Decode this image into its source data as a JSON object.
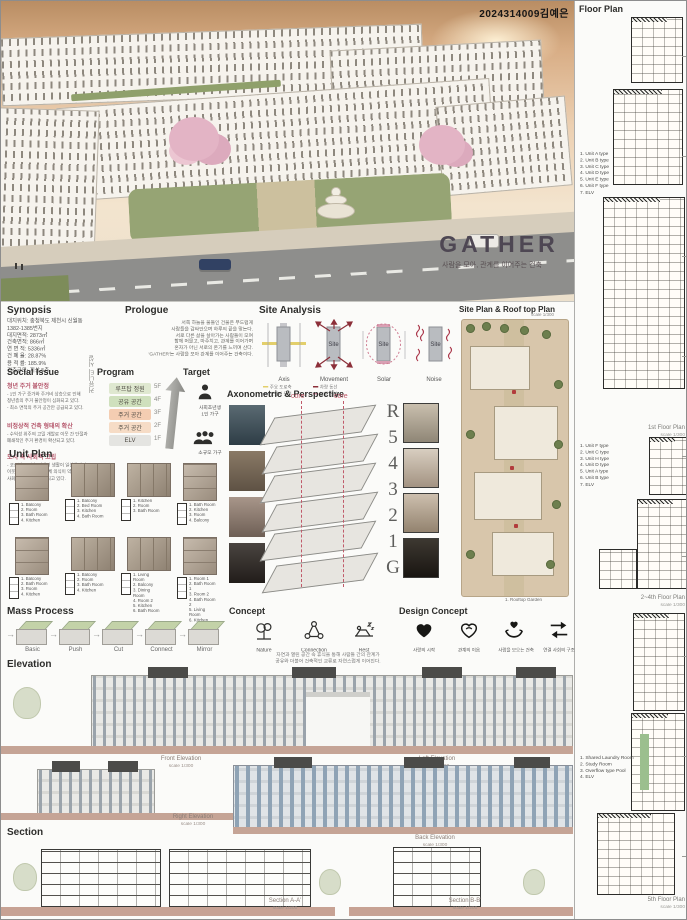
{
  "header": {
    "student_id": "2024314009김예은"
  },
  "hero": {
    "title": "GATHER",
    "subtitle": "사람을 모아, 관계를 이어주는 건축"
  },
  "synopsis": {
    "heading": "Synopsis",
    "lines": [
      "대지위치: 충청북도 제천시 신월동",
      "1382-1385번지",
      "대지면적: 2873㎡",
      "건축면적: 866㎡",
      "연 면 적: 5336㎡",
      "건 폐 율: 28.87%",
      "용 적 률: 185.9%",
      "건축규모: 지상 5층"
    ]
  },
  "prologue": {
    "heading": "Prologue",
    "text": "서쪽 하늘을 물들인 건물은 부드럽게\n사람들을 감싸안으며 하루의 끝을 맞는다.\n서로 다른 삶을 살아가는 사람들이 모여\n함께 머물고, 마주치고, 관계를 이어가며\n혼자가 아닌 서로의 온기를 느끼며 산다.\n'GATHER'는 사람을 모아 관계를 이어주는 건축이다."
  },
  "site_analysis": {
    "heading": "Site Analysis",
    "site_label": "Site",
    "diagrams": [
      {
        "label": "Axis"
      },
      {
        "label": "Movement"
      },
      {
        "label": "Solar"
      },
      {
        "label": "Noise"
      }
    ],
    "legends": [
      "주요 도로축",
      "보행자 동선",
      "차량 동선",
      "보행 동선"
    ]
  },
  "site_plan": {
    "heading": "Site Plan & Roof top Plan",
    "scale": "scale 1/300",
    "caption": "1. Rooftop Garden"
  },
  "social_issue": {
    "heading": "Social Issue",
    "items": [
      {
        "title": "청년 주거 불안정",
        "body": "- 1인 가구 증가와 주거비 상승으로 인해\n  청년층의 주거 불안정이 심화되고 있다.\n- 최소 면적의 주거 공간만 공급되고 있다."
      },
      {
        "title": "비정상적 건축 형태의 확산",
        "body": "- 수익성 위주의 고밀 개발로 이웃 간 단절과\n  폐쇄적인 주거 환경이 확산되고 있다."
      },
      {
        "title": "도시 속 사회적 고립",
        "body": "- 코로나19 이후 비대면 생활이 일상화되며\n  이웃 간의 교류와 공동체 의식이 약화되고\n  사회적 고립감이 심화되고 있다."
      }
    ]
  },
  "program": {
    "heading": "Program",
    "side_label": "커뮤니티 시설",
    "rows": [
      {
        "label": "루프탑 정원"
      },
      {
        "label": "공유 공간"
      },
      {
        "label": "주거 공간"
      },
      {
        "label": "주거 공간"
      },
      {
        "label": "ELV"
      }
    ],
    "floors": [
      "5F",
      "4F",
      "3F",
      "2F",
      "1F"
    ],
    "colors": {
      "row1": "#dfe8d0",
      "row2": "#cfe0bd",
      "row3": "#f4cdb2",
      "row4": "#f6dcc6",
      "row5": "#e4e4e1",
      "accent": "#8c2f39"
    }
  },
  "target": {
    "heading": "Target",
    "items": [
      {
        "label": "사회초년생\n1인 가구"
      },
      {
        "label": "소규모 가구"
      }
    ]
  },
  "unit_plan": {
    "heading": "Unit Plan",
    "units": [
      {
        "legend": "1. Balcony\n2. Room\n3. Bath Room\n4. Kitchen"
      },
      {
        "legend": "1. Balcony\n2. Bed Room\n3. Kitchen\n4. Bath Room"
      },
      {
        "legend": "1. Kitchen\n2. Room\n3. Bath Room"
      },
      {
        "legend": "1. Bath Room\n2. Kitchen\n3. Room\n4. Balcony"
      },
      {
        "legend": "1. Balcony\n2. Bath Room\n3. Room\n4. Kitchen"
      },
      {
        "legend": "1. Balcony\n2. Room\n3. Bath Room\n4. Kitchen"
      },
      {
        "legend": "1. Living Room\n2. Balcony\n3. Dining Room\n4. Room 2\n5. Kitchen\n6. Bath Room"
      },
      {
        "legend": "1. Room 1\n2. Bath Room 1\n3. Room 2\n4. Bath Room 2\n5. Living Room\n6. Kitchen"
      }
    ]
  },
  "axono": {
    "heading": "Axonometric & Perspective",
    "core_label": "core",
    "levels": [
      "R",
      "5",
      "4",
      "3",
      "2",
      "1",
      "G"
    ]
  },
  "mass_process": {
    "heading": "Mass Process",
    "steps": [
      {
        "label": "Basic"
      },
      {
        "label": "Push"
      },
      {
        "label": "Cut"
      },
      {
        "label": "Connect"
      },
      {
        "label": "Mirror"
      }
    ]
  },
  "concept": {
    "heading": "Concept",
    "items": [
      {
        "label": "Nature"
      },
      {
        "label": "Connection"
      },
      {
        "label": "Rest"
      }
    ],
    "caption": "자연과 열린 공간 속 휴식을 통해 사람들 간의 관계가\n공유와 더불어 건축적인 교류로 자연스럽게 이어진다."
  },
  "design_concept": {
    "heading": "Design Concept",
    "items": [
      {
        "label": "사랑의 시작"
      },
      {
        "label": "관계의 이음"
      },
      {
        "label": "사람을 모으는 건축"
      },
      {
        "label": "연결 사회의 구조"
      }
    ]
  },
  "elevation": {
    "heading": "Elevation",
    "captions": [
      {
        "title": "Front Elevation",
        "scale": "scale 1/300"
      },
      {
        "title": "Left Elevation",
        "scale": "scale 1/300"
      },
      {
        "title": "Right Elevation",
        "scale": "scale 1/300"
      },
      {
        "title": "Back Elevation",
        "scale": "scale 1/300"
      }
    ]
  },
  "sections": {
    "heading": "Section",
    "captions": [
      {
        "title": "Section A-A'",
        "scale": "scale 1/200"
      },
      {
        "title": "Section B-B'",
        "scale": "scale 1/200"
      }
    ]
  },
  "floor_plan": {
    "heading": "Floor Plan",
    "groups": [
      {
        "legend": "1. Unit A type\n2. Unit B type\n3. Unit C type\n4. Unit D type\n5. Unit E type\n6. Unit F type\n7. ELV",
        "caption": "1st Floor Plan",
        "scale": "scale 1/300"
      },
      {
        "legend": "1. Unit F type\n2. Unit C type\n3. Unit H type\n4. Unit D type\n5. Unit A type\n6. Unit B type\n7. ELV",
        "caption": "2~4th Floor Plan",
        "scale": "scale 1/300"
      },
      {
        "legend": "1. Shared Laundry Room\n2. Study Room\n3. Overflow type Pool\n4. ELV",
        "caption": "5th Floor Plan",
        "scale": "scale 1/300"
      }
    ]
  }
}
